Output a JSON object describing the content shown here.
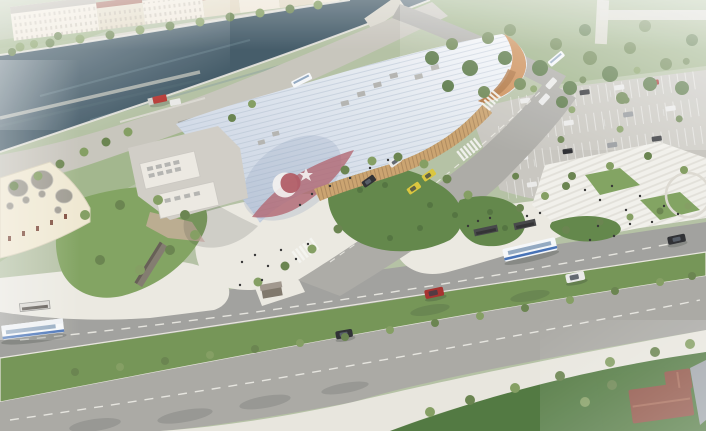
{
  "scene": {
    "type": "aerial-architectural-rendering",
    "subject": "wave-roofed terminal building beside a river canal with landscaped plazas, park, parking lot and boulevard",
    "roof_motif": {
      "flag_field": "faded red",
      "crescent": "white",
      "star": "white"
    },
    "elements": [
      "river canal with stepped embankment",
      "riverside building row with red tile roofs",
      "tree-lined promenades",
      "white ribbed wave-form station roof sweeping to the ground",
      "crescent-and-star flag motif painted on roof swoop",
      "timber curl at right roof end",
      "timber-mullion glass facade",
      "service buildings with rooftop HVAC units",
      "red truck and white van in service yard",
      "domed historic building at lower left",
      "landscaped lawns, shrub islands and white plazas",
      "monument wall with pink paving",
      "amphitheater steps with pedestrians",
      "surface parking lot with stall rows, cars, trees and light poles",
      "city park with dense tree clusters and paths",
      "boulevard with green median and street trees",
      "zebra crosswalks and dashed lane markings",
      "bus stops with shelters",
      "suburban house with hip roof at lower right"
    ],
    "vehicles": {
      "buses": 4,
      "taxis": 2,
      "cars_on_roads": 8,
      "cars_in_parking": 17,
      "service_vehicles": 2
    }
  },
  "colors": {
    "base": "#b2bfa1",
    "river": "#3d5563",
    "river_reflection": "#74909c",
    "bank_path": "#d8d5ca",
    "bank_lawn": "#9cb285",
    "building_wall": "#f0e9da",
    "building_wall_alt": "#e2d8c2",
    "building_roof_red": "#9b5848",
    "building_roof_gray": "#b0aca0",
    "park": "#97ad80",
    "park_path": "#d9d7cd",
    "tree": "#647f48",
    "tree_light": "#7f9a5c",
    "tree_dark": "#51713d",
    "road_river": "#c6c3ba",
    "station_roof_light": "#f4f6f9",
    "station_roof_shade": "#c3cfdf",
    "roof_rib": "#aebccd",
    "flag_red": "#ad5560",
    "flag_white": "#f4f2f0",
    "facade_wood": "#c9a06a",
    "wood_stripe": "#8d6a44",
    "roof_curl": "#c9884e",
    "roof_curl_shade": "#a86a34",
    "service_building": "#ebe8e1",
    "service_yard": "#cfccc5",
    "hvac": "#b2b2ae",
    "dome_building": "#efe7d0",
    "dome": "#9a968c",
    "window_brown": "#7a4636",
    "lawn": "#7da05b",
    "lawn_dark": "#5c8243",
    "shrub": "#4c6e38",
    "plaza": "#eae8e0",
    "steps": "#f1f0ea",
    "step_line": "#d6d4cc",
    "road": "#9e9e9a",
    "road_lower": "#a7a6a1",
    "access_road": "#a9a8a3",
    "median": "#6f9150",
    "sidewalk": "#e7e5dd",
    "parking": "#c7c5be",
    "monument": "#7e766a",
    "pink_paving": "#d8aea8",
    "kiosk": "#7b7266",
    "kiosk_roof": "#9d948a",
    "shelter_dark": "#3f4042",
    "shelter_light": "#d9d7d2",
    "bus_body": "#f5f7f9",
    "bus_stripe": "#3f6cb4",
    "bus_window": "#8fa6bf",
    "taxi_yellow": "#d9c335",
    "car_red": "#a32a26",
    "car_white": "#e9e9e8",
    "car_black": "#26282c",
    "car_gray": "#8e9296",
    "truck_red": "#b53430",
    "van_white": "#e8e8e6",
    "house_roof": "#8a4a3c",
    "house_lawn": "#4a7339",
    "gray_building": "#9aa0a6",
    "people": "#2e2e2e"
  }
}
